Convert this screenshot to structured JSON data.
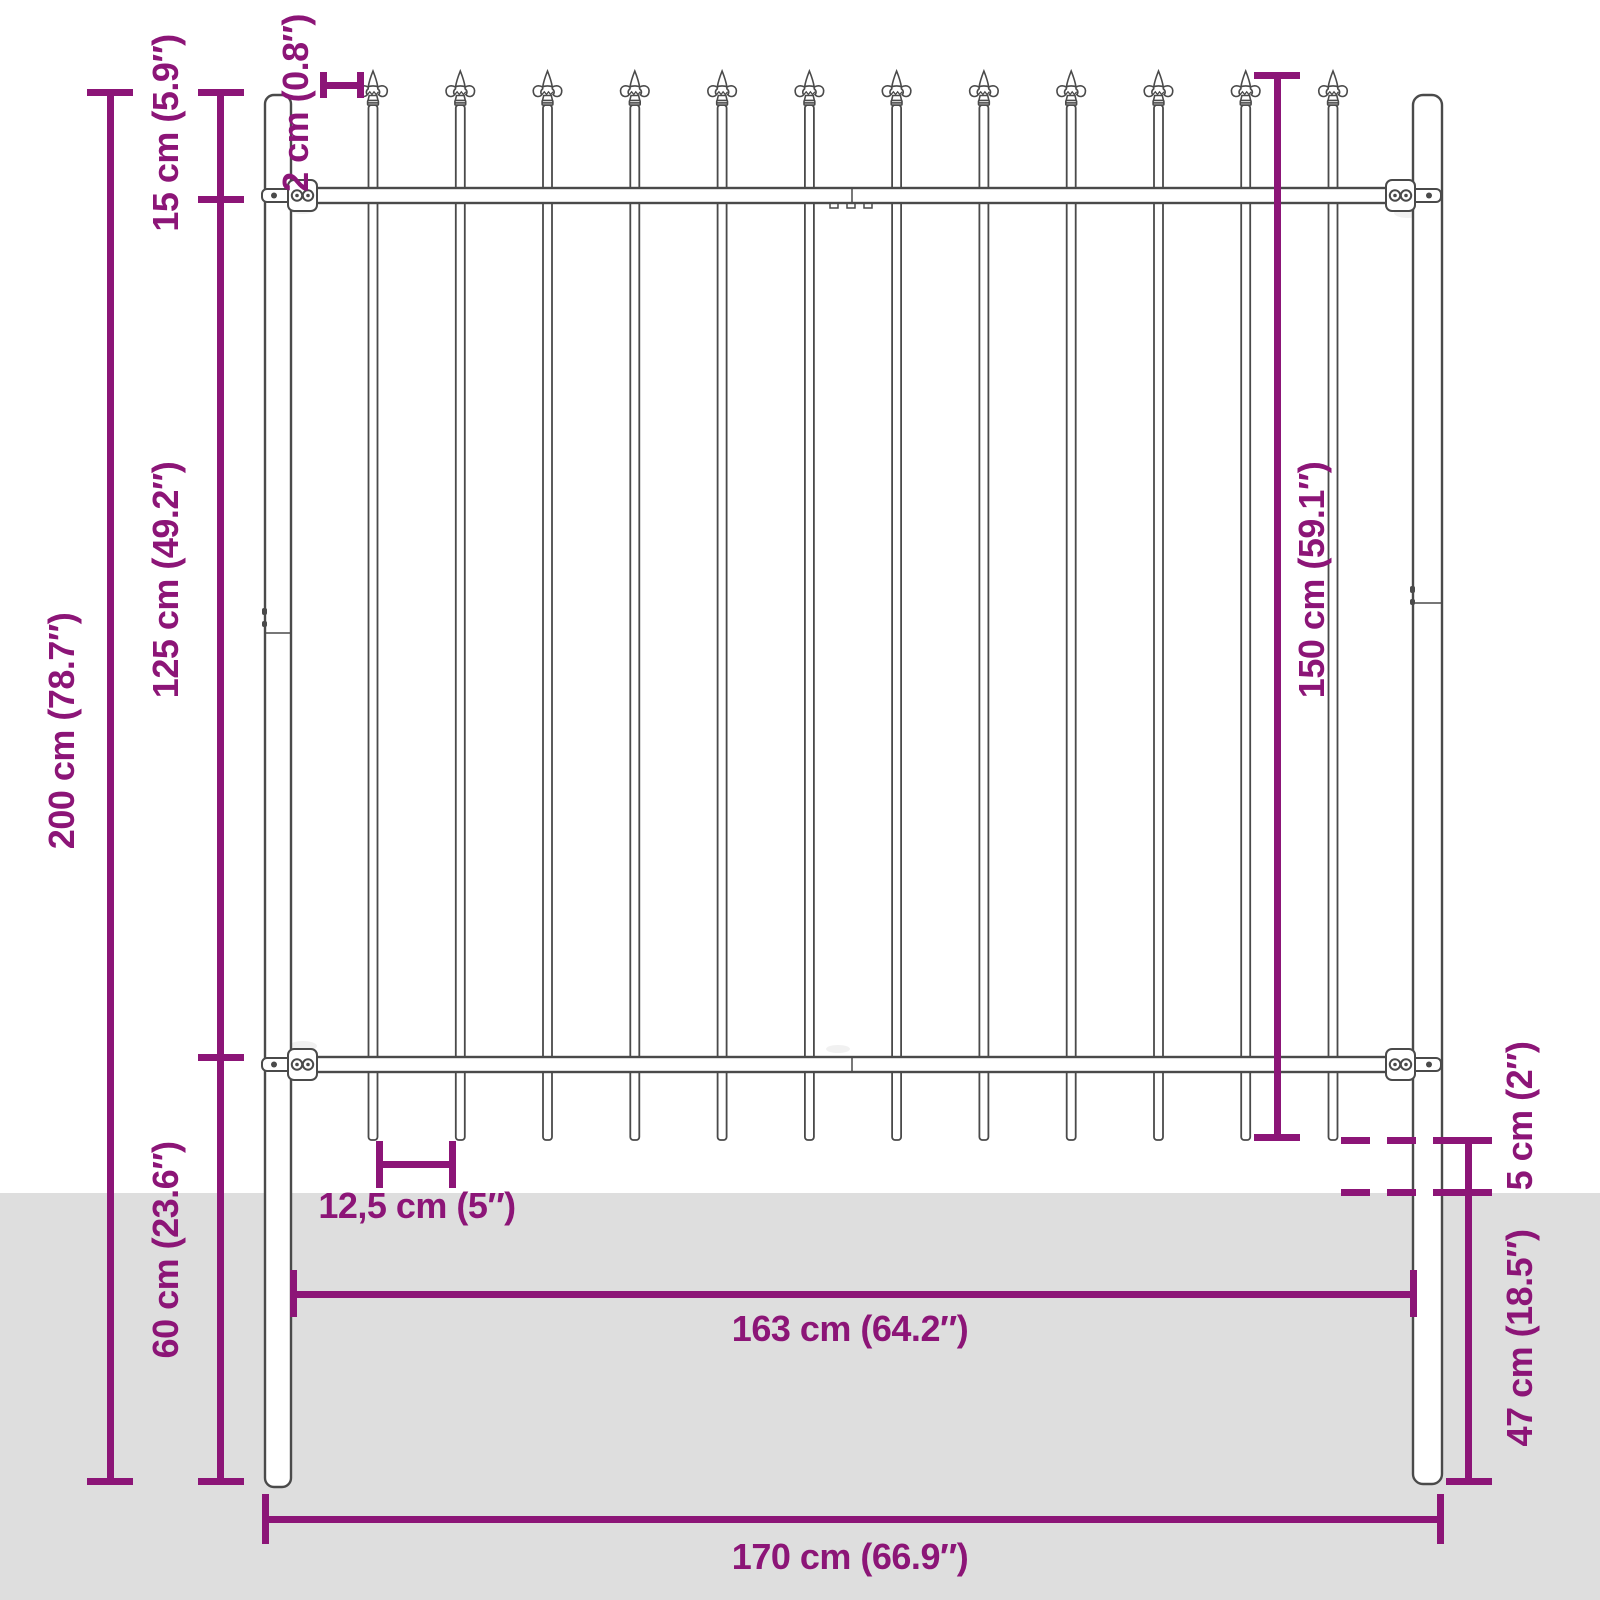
{
  "title": "Fence panel dimension diagram",
  "colors": {
    "dimension": "#8C1577",
    "ground": "#DEDEDE",
    "outline": "#4A4A4A",
    "background": "#FFFFFF"
  },
  "labels": {
    "total_height": "200 cm (78.7″)",
    "top_section_height": "15 cm (5.9″)",
    "middle_section_height": "125 cm (49.2″)",
    "bottom_section_height": "60 cm (23.6″)",
    "spear_offset": "2 cm (0.8″)",
    "panel_height": "150 cm (59.1″)",
    "bar_spacing": "12,5 cm (5″)",
    "inner_width": "163 cm (64.2″)",
    "ground_clearance": "5 cm (2″)",
    "buried_depth": "47 cm (18.5″)",
    "outer_width": "170 cm (66.9″)"
  },
  "illustration": {
    "bar_count": 12,
    "post_count": 2,
    "finial_style": "spear"
  }
}
